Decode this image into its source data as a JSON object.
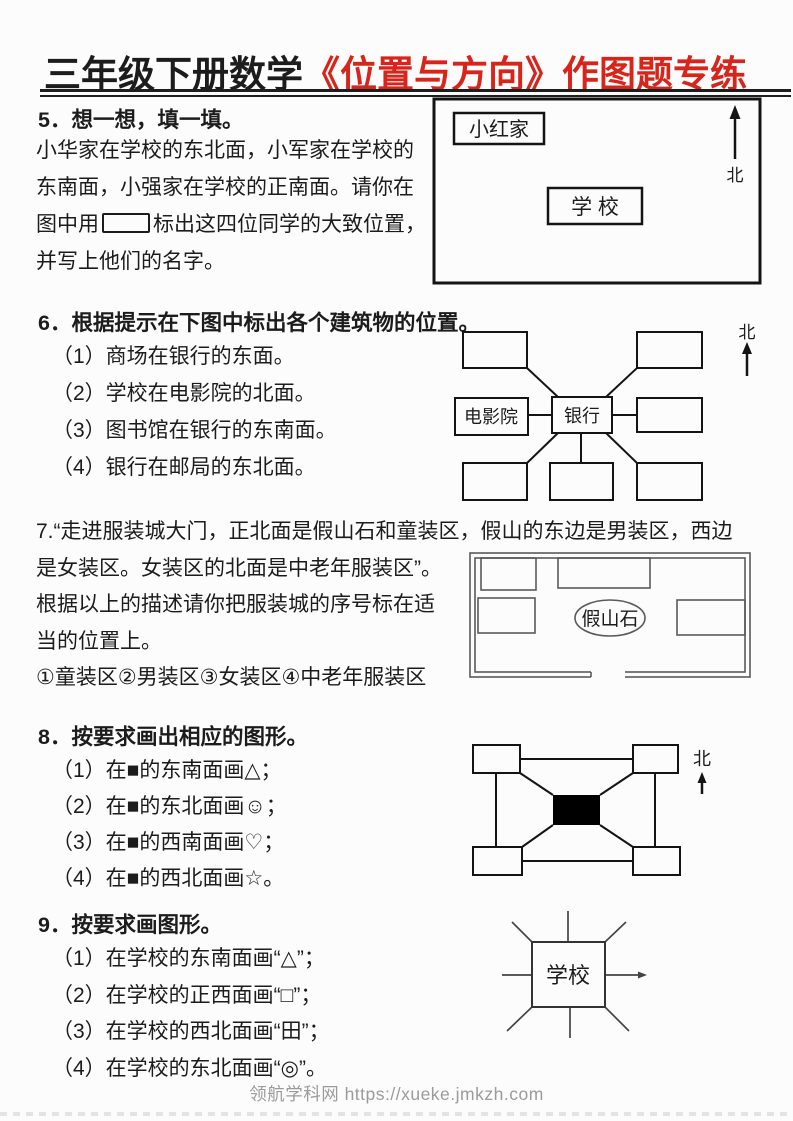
{
  "header": {
    "title_black": "三年级下册数学",
    "title_red": "《位置与方向》作图题专练"
  },
  "q5": {
    "heading": "5．想一想，填一填。",
    "line1": "小华家在学校的东北面，小军家在学校的",
    "line2": "东南面，小强家在学校的正南面。请你在",
    "line3_pre": "图中用",
    "line3_post": "标出这四位同学的大致位置，",
    "line4": "并写上他们的名字。",
    "diagram": {
      "xiaohong_label": "小红家",
      "school_label": "学 校",
      "north_label": "北"
    }
  },
  "q6": {
    "heading": "6．根据提示在下图中标出各个建筑物的位置。",
    "items": [
      "（1）商场在银行的东面。",
      "（2）学校在电影院的北面。",
      "（3）图书馆在银行的东南面。",
      "（4）银行在邮局的东北面。"
    ],
    "diagram": {
      "cinema_label": "电影院",
      "bank_label": "银行",
      "north_label": "北"
    }
  },
  "q7": {
    "line1": "7.“走进服装城大门，正北面是假山石和童装区，假山的东边是男装区，西边",
    "line2": "是女装区。女装区的北面是中老年服装区”。",
    "line3": "根据以上的描述请你把服装城的序号标在适",
    "line4": "当的位置上。",
    "options": "①童装区②男装区③女装区④中老年服装区",
    "diagram": {
      "rock_label": "假山石"
    }
  },
  "q8": {
    "heading": "8．按要求画出相应的图形。",
    "items": [
      "（1）在■的东南面画△；",
      "（2）在■的东北面画☺；",
      "（3）在■的西南面画♡；",
      "（4）在■的西北面画☆。"
    ],
    "diagram": {
      "north_label": "北"
    }
  },
  "q9": {
    "heading": "9．按要求画图形。",
    "items": [
      "（1）在学校的东南面画“△”；",
      "（2）在学校的正西面画“□”；",
      "（3）在学校的西北面画“田”；",
      "（4）在学校的东北面画“◎”。"
    ],
    "diagram": {
      "school_label": "学校"
    }
  },
  "footer": {
    "watermark": "领航学科网 https://xueke.jmkzh.com"
  },
  "colors": {
    "accent_red": "#d8251b",
    "ink": "#1c1c1c",
    "watermark_gray": "#9b9b9b"
  }
}
